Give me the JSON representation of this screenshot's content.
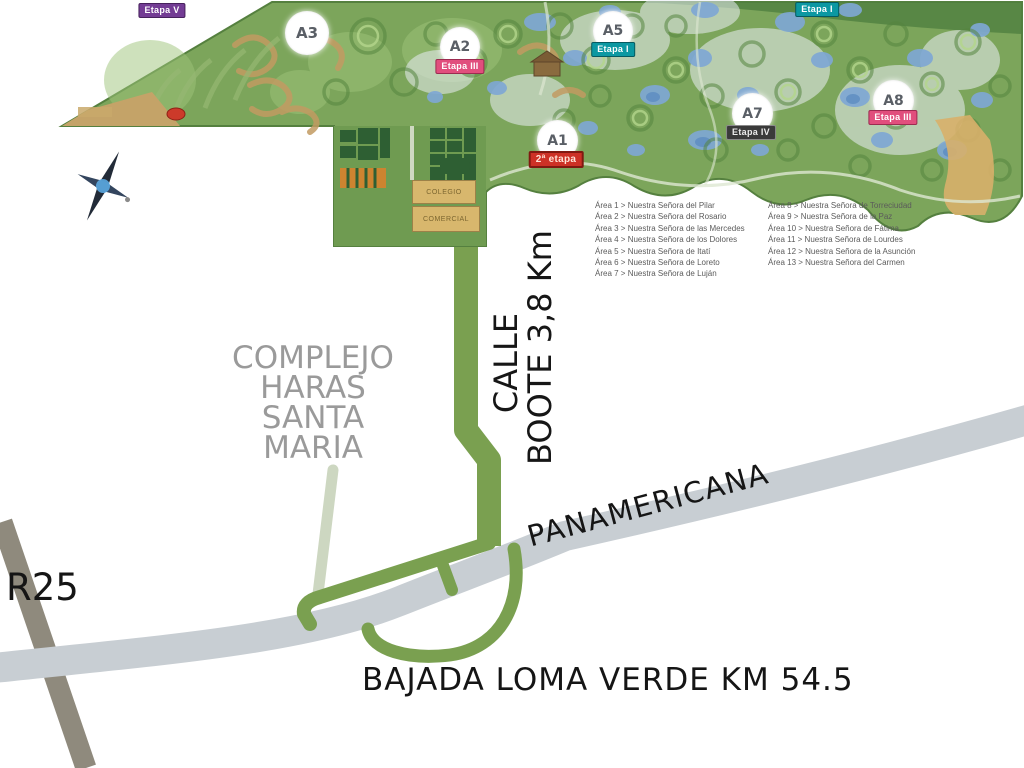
{
  "map": {
    "region_labels": {
      "complejo_lines": [
        "COMPLEJO",
        "HARAS",
        "SANTA",
        "MARIA"
      ],
      "calle_line1": "CALLE",
      "calle_line2": "BOOTE 3,8 Km",
      "panamericana": "PANAMERICANA",
      "r25": "R25",
      "bajada": "BAJADA LOMA VERDE KM 54.5"
    },
    "markers": [
      {
        "id": "a3",
        "label": "A3",
        "etapa": ""
      },
      {
        "id": "a2",
        "label": "A2",
        "etapa": "Etapa III"
      },
      {
        "id": "a5",
        "label": "A5",
        "etapa": "Etapa I"
      },
      {
        "id": "a1",
        "label": "A1",
        "etapa": "2ª etapa"
      },
      {
        "id": "a7",
        "label": "A7",
        "etapa": "Etapa IV"
      },
      {
        "id": "a8",
        "label": "A8",
        "etapa": "Etapa III"
      }
    ],
    "stage_badges": {
      "top_left": "Etapa V",
      "top_right": "Etapa I"
    },
    "zones": {
      "box1": "COLEGIO",
      "box2": "COMERCIAL"
    },
    "legend": {
      "col1": [
        "Área 1 > Nuestra Señora del Pilar",
        "Área 2 > Nuestra Señora del Rosario",
        "Área 3 > Nuestra Señora de las Mercedes",
        "Área 4 > Nuestra Señora de los Dolores",
        "Área 5 > Nuestra Señora de Itatí",
        "Área 6 > Nuestra Señora de Loreto",
        "Área 7 > Nuestra Señora de Luján"
      ],
      "col2": [
        "Área 8 > Nuestra Señora de Torreciudad",
        "Área 9 > Nuestra Señora de la Paz",
        "Área 10 > Nuestra Señora de Fátima",
        "Área 11 > Nuestra Señora de Lourdes",
        "Área 12 > Nuestra Señora de la Asunción",
        "Área 13 > Nuestra Señora del Carmen"
      ]
    },
    "colors": {
      "complex_green": "#7ca55b",
      "road_green": "#7aa050",
      "pale_road": "#cdd7c1",
      "panamericana_gray": "#c8ced3",
      "r25_gray": "#8f8a7d",
      "lake_blue": "#7fa8d4",
      "sand_tan": "#d8b76d",
      "badge_teal": "#0c98a2",
      "badge_pink": "#e14e7d",
      "badge_red": "#cd3126",
      "badge_dark": "#3a3a3a",
      "badge_purple": "#733c94",
      "title_gray": "#9a9a9a"
    }
  }
}
